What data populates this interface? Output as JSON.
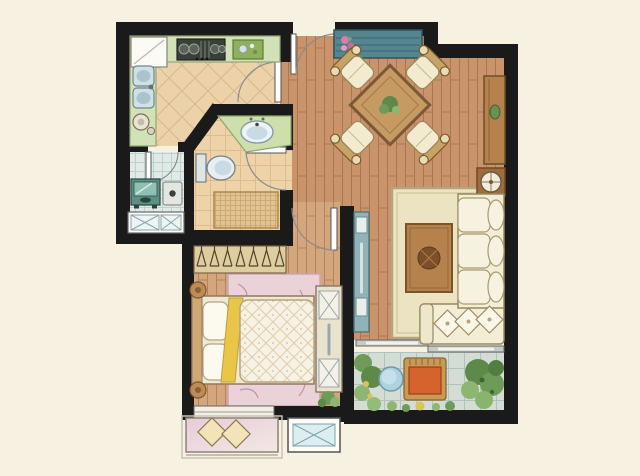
{
  "meta": {
    "type": "apartment-floor-plan",
    "canvas_width": 640,
    "canvas_height": 476
  },
  "palette": {
    "bg": "#f6f1e0",
    "wall": "#1a1a1a",
    "wood_base": "#c9946c",
    "wood_line": "#aa774e",
    "bedwood_base": "#d3a67e",
    "bedwood_line": "#b5835d",
    "kitchen_tile": "#ecd2a9",
    "kitchen_tile_line": "#d8b88c",
    "bath_tile": "#eed3a8",
    "bath_tile_line": "#dcbc90",
    "laundry_tile": "#e0ebe7",
    "laundry_tile_line": "#bdd2cc",
    "balcony_tile": "#d3ddd6",
    "balcony_tile_line": "#b2c3bb",
    "counter_green": "#d3e2b6",
    "vanity_green": "#cfdfac",
    "rug_living": "#ece3c3",
    "rug_living_edge": "#b3a679",
    "rug_bedroom": "#ead2d8",
    "rug_bedroom_edge": "#cba6b0",
    "sofa_cream": "#f3edd6",
    "sofa_edge": "#97885e",
    "cushion_cream": "#f7f2e0",
    "wood_furniture": "#b5824e",
    "wood_furniture_dark": "#7c5529",
    "table_wood": "#c59a63",
    "console_teal": "#55858e",
    "console_teal_dark": "#3a6670",
    "cabinet_teal": "#8fb3b6",
    "duvet": "#f7f2e3",
    "duvet_line": "#dccfae",
    "bed_yellow": "#e9c648",
    "bay_pink_a": "#e7ccd9",
    "bay_pink_b": "#f2e8e4",
    "plant_dark": "#5d8a49",
    "plant_mid": "#6e9b58",
    "plant_light": "#8fb573",
    "plant_yellow": "#d9c35a",
    "chair_orange": "#d4632e",
    "chair_frame": "#c99a55",
    "table_blue": "#aed2e0",
    "mat_tan": "#e2c491",
    "mat_line": "#c9a371",
    "appliance_dark": "#3a3f3a",
    "washer_teal": "#5d8f85",
    "washer_screen": "#8fc0b4",
    "sink_blue": "#cfe0e6",
    "basin_blue": "#c8dbe4",
    "white_fixture": "#fdfcf6",
    "door_leaf": "#ffffff",
    "door_arc": "#8c8c8c",
    "ac_panel": "#ddeef0",
    "ac_line": "#7fa3ad",
    "flower_pink": "#d67fa8",
    "closet_tan": "#ddcd9f"
  },
  "rooms": {
    "kitchen": {
      "floor": "diagonal-tile",
      "furniture": [
        "refrigerator",
        "gas-cooktop",
        "cutting-board",
        "double-sink",
        "kettle",
        "swing-door"
      ]
    },
    "laundry": {
      "floor": "small-tile",
      "furniture": [
        "washing-machine",
        "dryer",
        "ac-platform-x-panels",
        "swing-door"
      ]
    },
    "bathroom": {
      "floor": "square-tile",
      "furniture": [
        "vanity-counter-sink",
        "toilet",
        "shower-mat",
        "swing-door"
      ]
    },
    "hallway": {
      "furniture": [
        "wardrobe-with-hangers"
      ]
    },
    "bedroom": {
      "floor": "wood-plank",
      "furniture": [
        "double-bed",
        "pillows",
        "quilted-duvet",
        "bedside-stools",
        "floral-rug",
        "tall-dresser",
        "potted-plant",
        "bay-window-seat-with-cushions",
        "swing-door",
        "ac-platform"
      ]
    },
    "living_dining": {
      "floor": "wood-plank",
      "furniture": [
        "entry-door",
        "teal-console-table",
        "flower-decor",
        "square-dining-table",
        "dining-chairs-x4",
        "table-plant",
        "tv-cabinet",
        "green-decor",
        "lamp-side-table",
        "cream-rug",
        "coffee-table",
        "l-shaped-sofa",
        "bolster-cushions-x3",
        "throw-pillows-x3",
        "teal-storage-cabinet",
        "sliding-door"
      ]
    },
    "balcony": {
      "floor": "square-tile",
      "furniture": [
        "lounge-chair",
        "round-side-table",
        "planting-greenery"
      ]
    }
  },
  "counts": {
    "dining_chairs": 4,
    "sofa_seat_cushions": 3,
    "throw_pillows": 3,
    "closet_hangers": 7,
    "bed_pillows": 2
  }
}
